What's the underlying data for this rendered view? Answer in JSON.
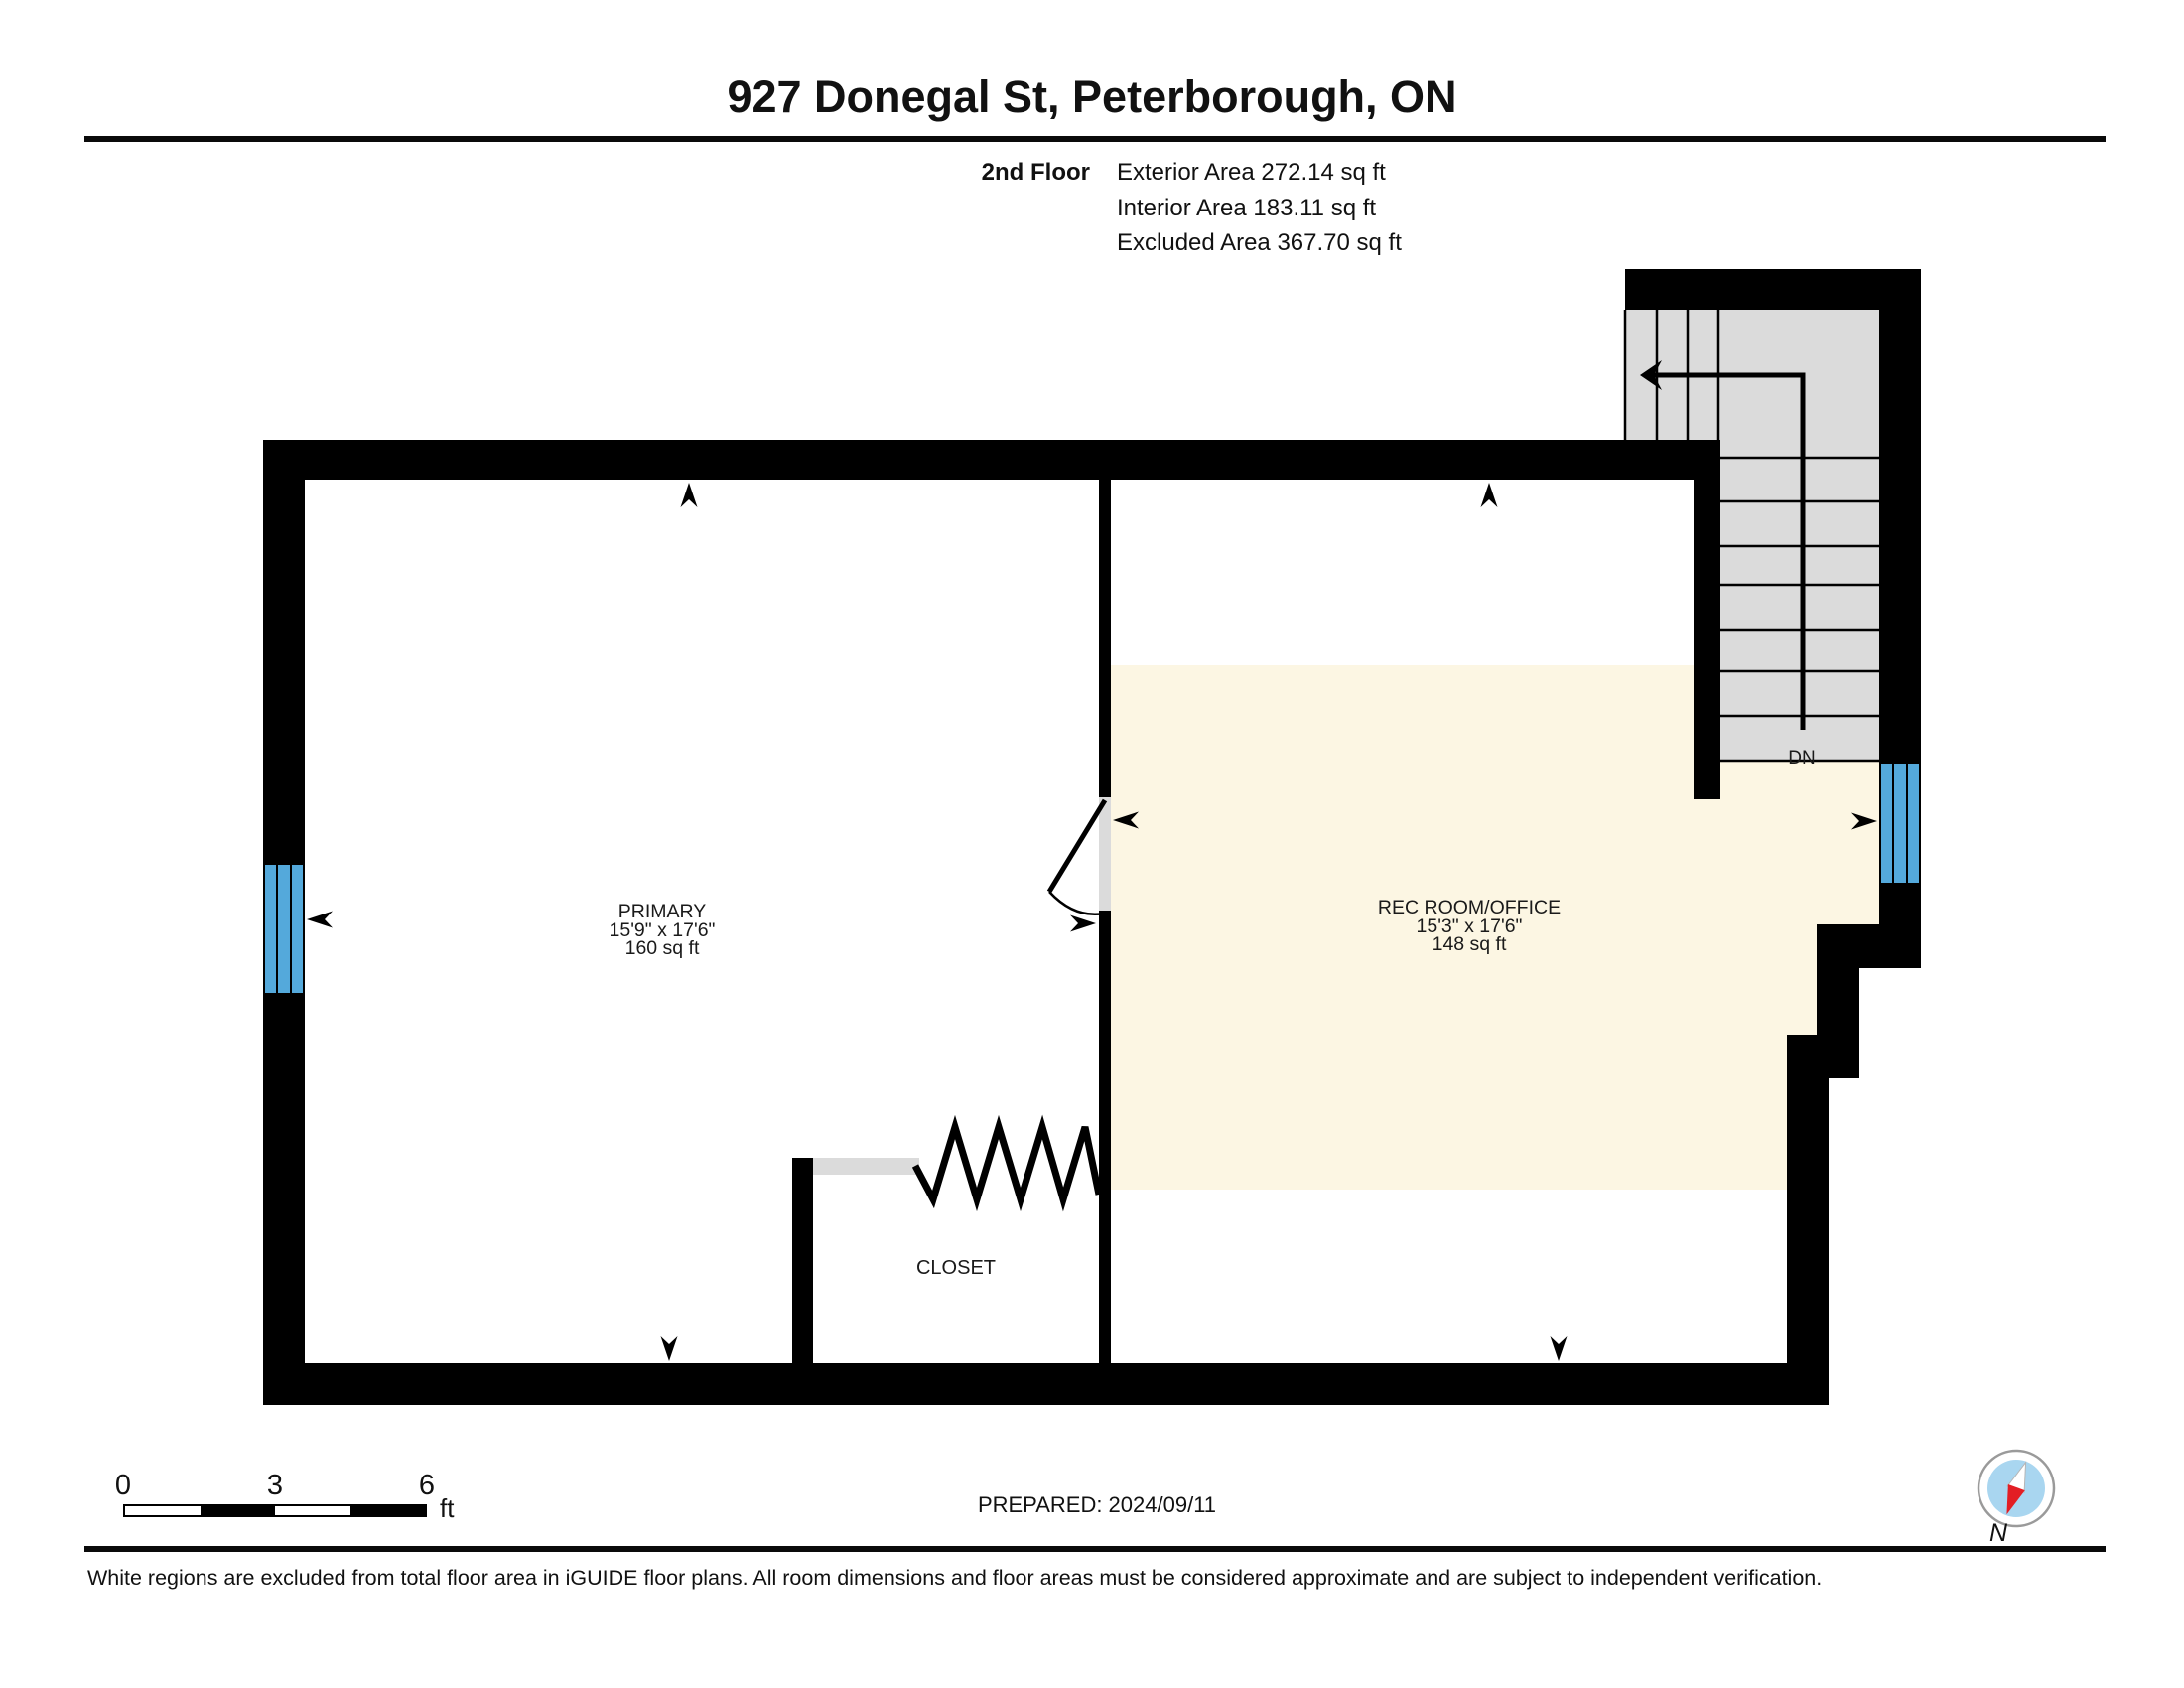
{
  "header": {
    "title": "927 Donegal St, Peterborough, ON",
    "floor_label": "2nd Floor",
    "exterior_area": "Exterior Area 272.14 sq ft",
    "interior_area": "Interior Area 183.11 sq ft",
    "excluded_area": "Excluded Area 367.70 sq ft"
  },
  "rooms": {
    "primary": {
      "name": "PRIMARY",
      "dimensions": "15'9\" x 17'6\"",
      "area": "160 sq ft"
    },
    "rec_room": {
      "name": "REC ROOM/OFFICE",
      "dimensions": "15'3\" x 17'6\"",
      "area": "148 sq ft"
    },
    "closet": {
      "name": "CLOSET"
    },
    "stairs": {
      "down_label": "DN"
    }
  },
  "scale_bar": {
    "tick_0": "0",
    "tick_3": "3",
    "tick_6": "6",
    "unit": "ft"
  },
  "compass": {
    "north_label": "N"
  },
  "footer": {
    "prepared": "PREPARED: 2024/09/11",
    "disclaimer": "White regions are excluded from total floor area in iGUIDE floor plans. All room dimensions and floor areas must be considered approximate and are subject to independent verification."
  },
  "colors": {
    "wall": "#000000",
    "included_room_fill": "#FCF6E3",
    "stair_fill": "#DBDBDB",
    "window_blue": "#54A9DB",
    "compass_blue": "#A9D6F0",
    "compass_red": "#E31E24"
  }
}
